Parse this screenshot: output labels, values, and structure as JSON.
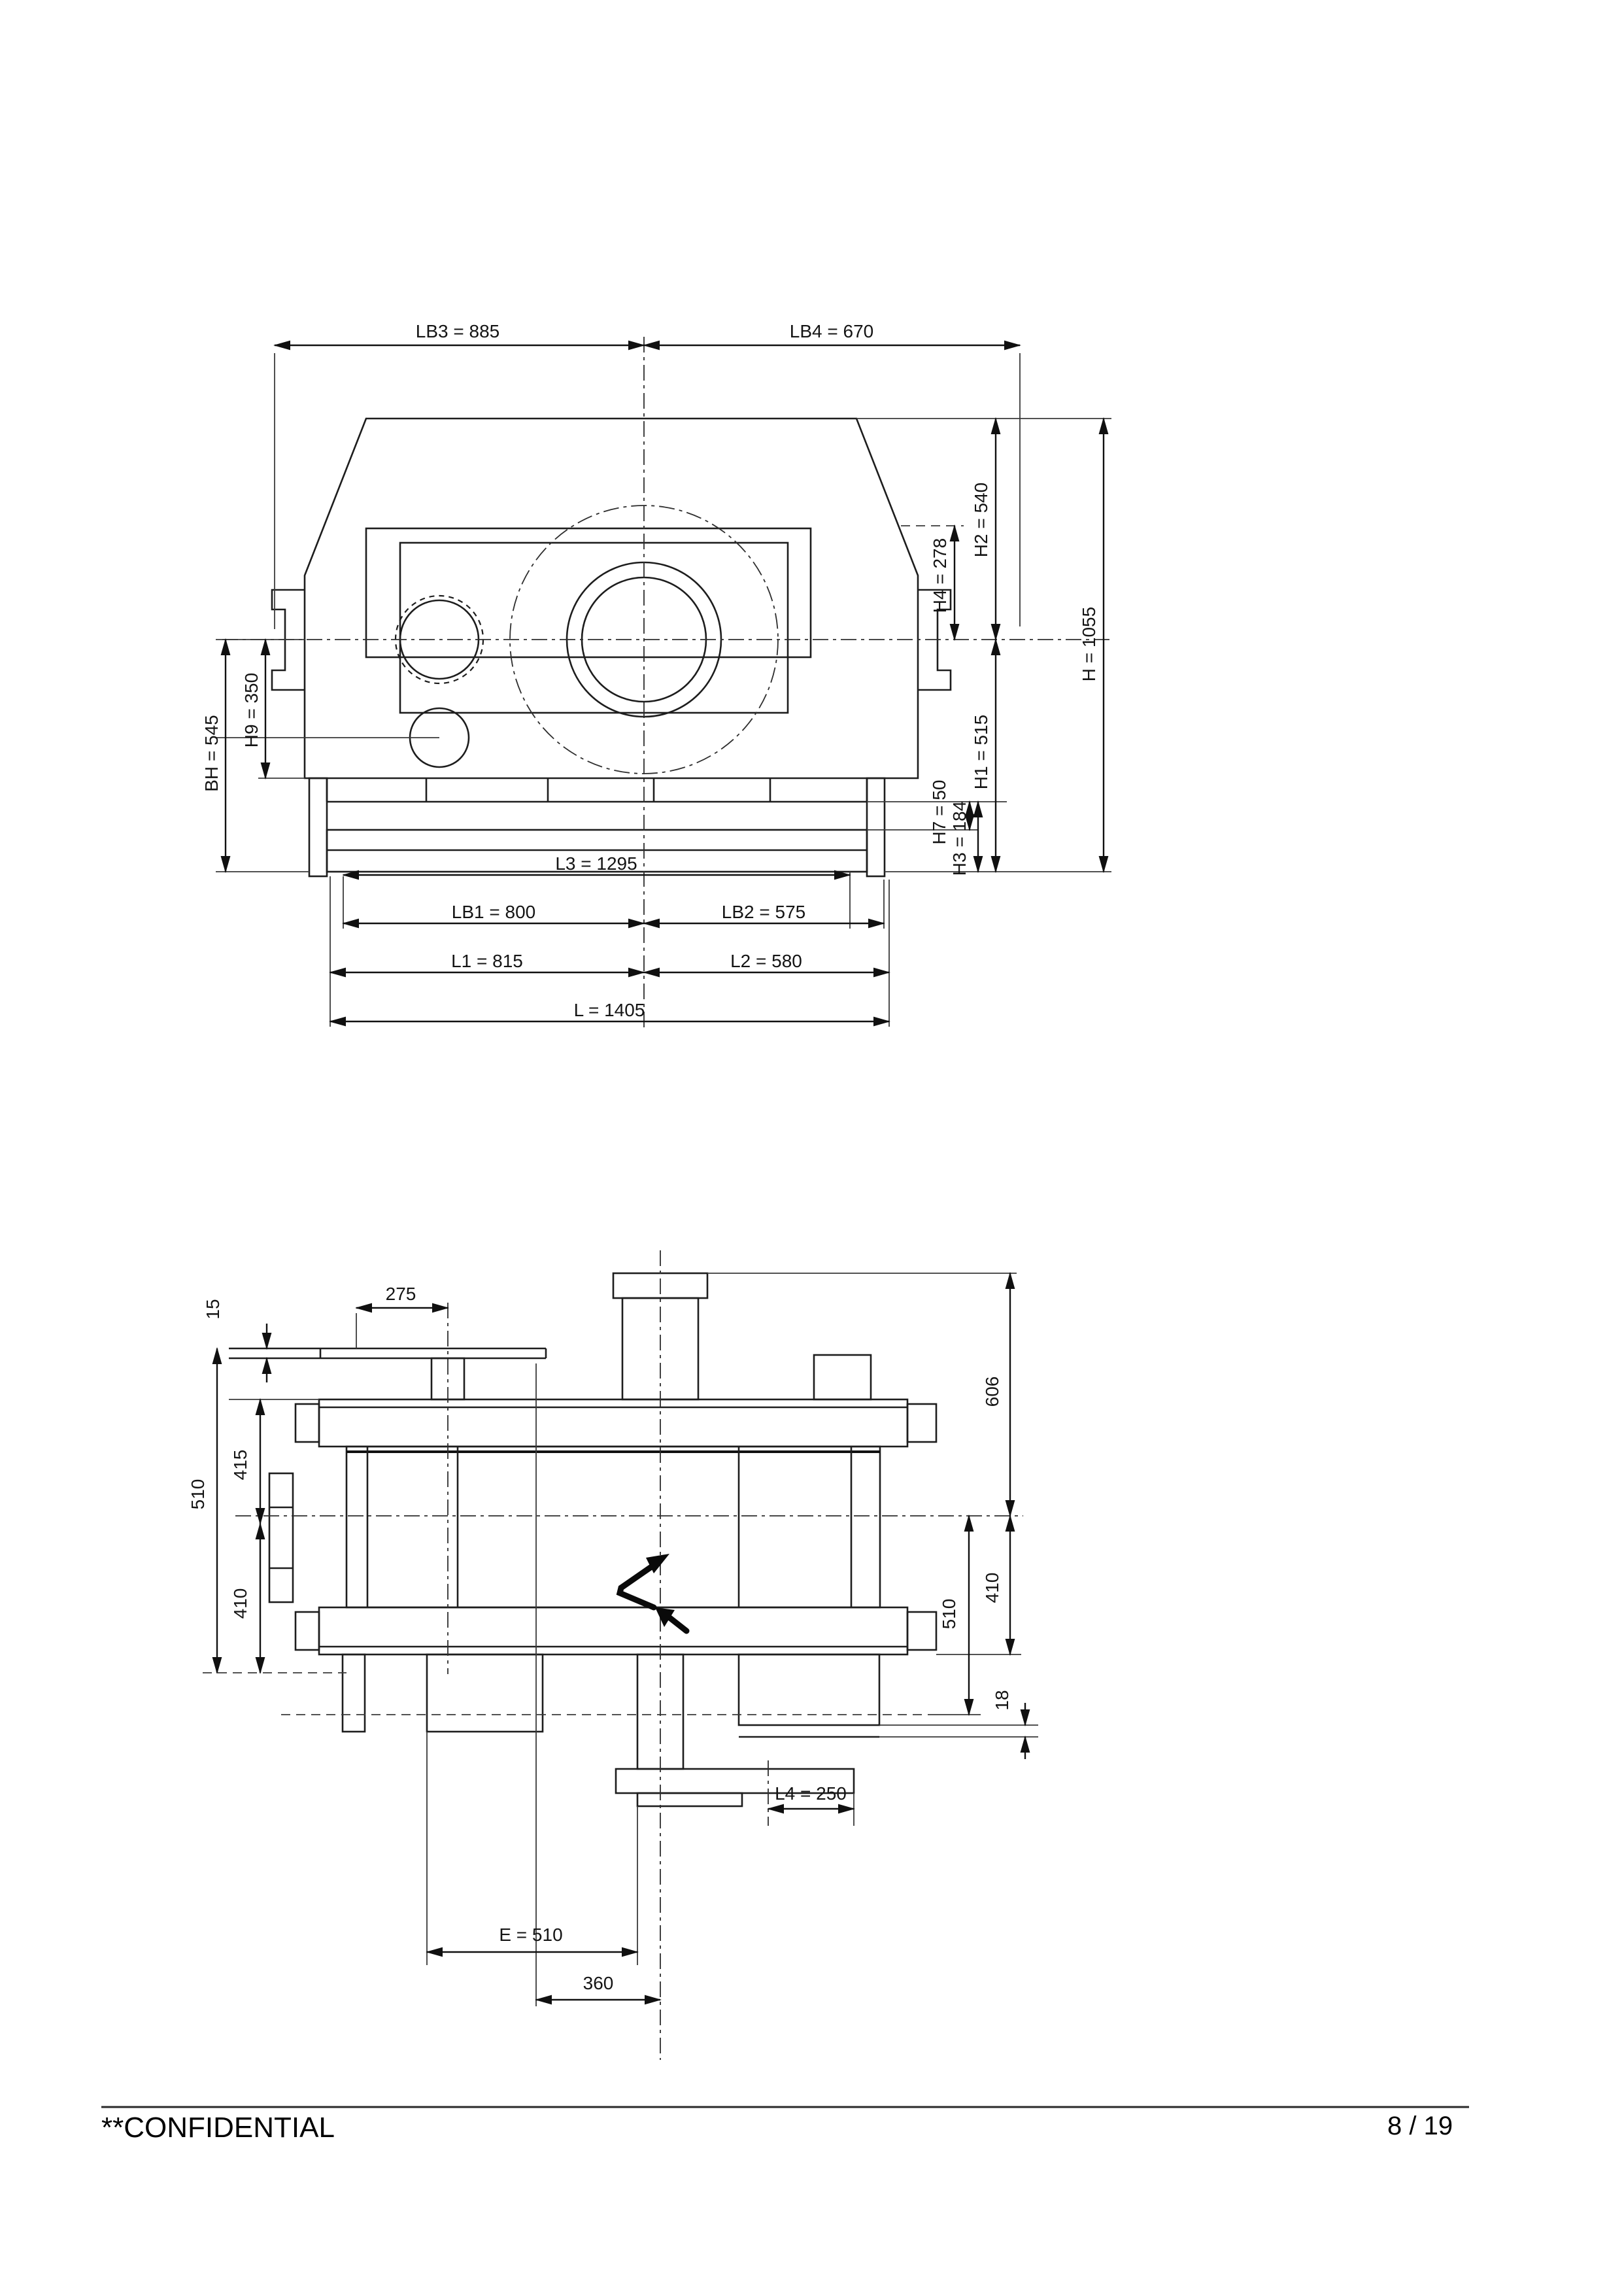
{
  "footer": {
    "confidential_label": "**CONFIDENTIAL",
    "page_indicator": "8 / 19"
  },
  "front_view": {
    "description": "gearbox front elevation with chained dimensions",
    "dims": {
      "lb3": "LB3 = 885",
      "lb4": "LB4 = 670",
      "h4": "H4 = 278",
      "h2": "H2 = 540",
      "h": "H = 1055",
      "h1": "H1 = 515",
      "bh": "BH = 545",
      "h9": "H9 = 350",
      "h7": "H7 = 50",
      "h3": "H3 = 184",
      "l3": "L3 = 1295",
      "lb1": "LB1 = 800",
      "lb2": "LB2 = 575",
      "l1": "L1 = 815",
      "l2": "L2 = 580",
      "l": "L = 1405"
    }
  },
  "plan_view": {
    "description": "gearbox plan view with shaft stubs and feet",
    "dims": {
      "d275": "275",
      "d15": "15",
      "d510_left": "510",
      "d415": "415",
      "d410_left": "410",
      "d606": "606",
      "d510_right": "510",
      "d410_right": "410",
      "d18": "18",
      "l4": "L4 = 250",
      "e": "E = 510",
      "d360": "360"
    }
  }
}
